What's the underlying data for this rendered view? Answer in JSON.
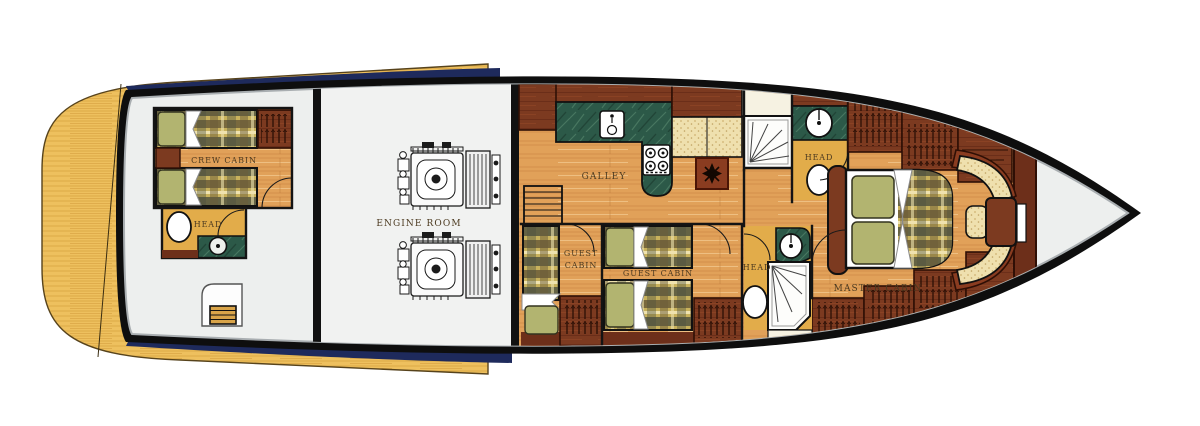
{
  "labels": {
    "crew_cabin": "CREW CABIN",
    "aft_head": "HEAD",
    "engine_room": "ENGINE ROOM",
    "galley": "GALLEY",
    "guest_cabin_small_line1": "GUEST",
    "guest_cabin_small_line2": "CABIN",
    "guest_cabin": "GUEST CABIN",
    "mid_head": "HEAD",
    "fwd_head": "HEAD",
    "master_cabin": "MASTER CABIN"
  },
  "colors": {
    "hull_stripe_navy": "#1e2a5c",
    "deck_wood_yellow": "#eec05e",
    "hull_outline_black": "#0e0e0e",
    "interior_gray": "#edefee",
    "floor_wood_orange": "#e1a159",
    "head_floor_yellow": "#e2ac4a",
    "cabinetry_redbrown": "#7c3a20",
    "counter_green_marble": "#2c5948",
    "plaid_fabric": "#c9b25c",
    "pillow_green": "#b2b470",
    "cushion_cream": "#efe0ae"
  }
}
